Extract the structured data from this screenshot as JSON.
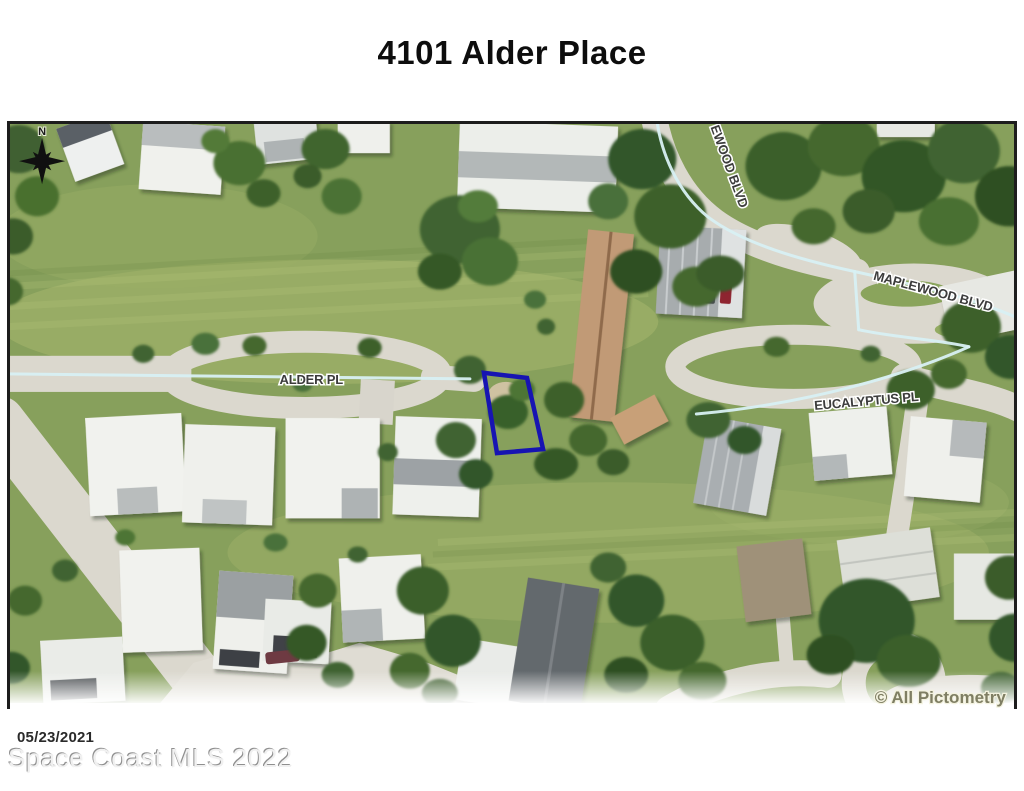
{
  "page": {
    "title": "4101 Alder Place",
    "photo_date": "05/23/2021",
    "mls_watermark": "Space Coast MLS 2022"
  },
  "map": {
    "type": "aerial-photo",
    "copyright": "© All Pictometry",
    "compass_north_label": "N",
    "streets": {
      "alder": "ALDER PL",
      "maplewood": "MAPLEWOOD BLVD",
      "maplewood_clipped": "EWOOD BLVD",
      "eucalyptus": "EUCALYPTUS PL"
    },
    "parcel_outline_color": "#1714b2",
    "centerline_color": "#d8f0f3"
  }
}
